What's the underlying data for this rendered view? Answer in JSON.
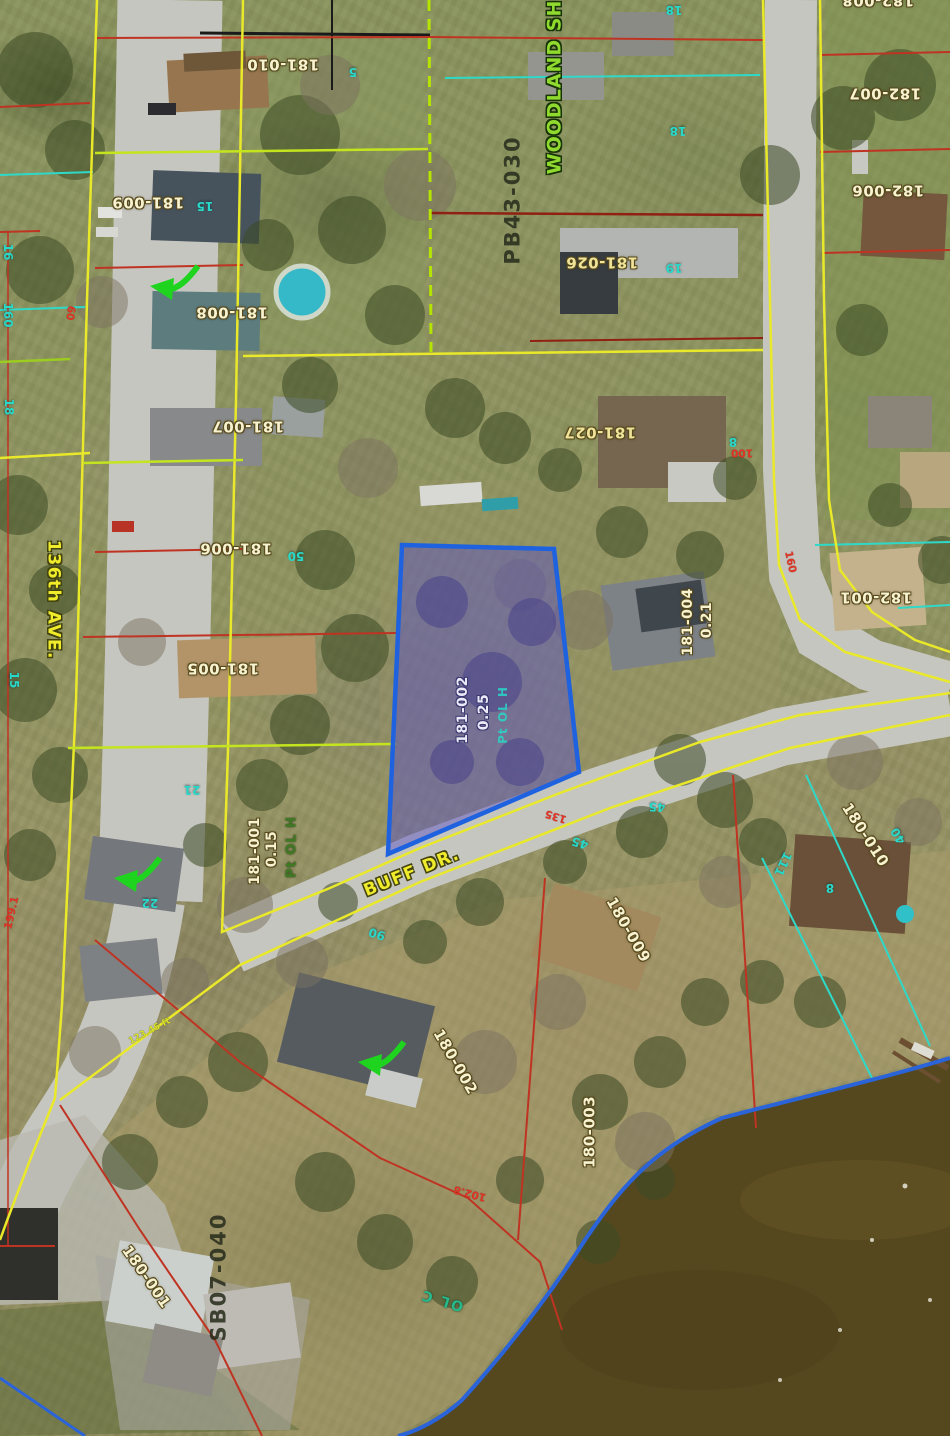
{
  "map": {
    "highlighted_parcel": {
      "id": "181-002",
      "acreage": "0.25"
    },
    "streets": {
      "ave": "136th AVE.",
      "buff": "BUFF DR.",
      "woodland": "WOODLAND SH"
    },
    "plat_labels": {
      "pb": "PB43-030",
      "sb": "SB07-040"
    },
    "outlot_labels": {
      "pt_ol_h_west": "Pt OL H",
      "pt_ol_h_center": "Pt OL H",
      "ol_c": "OL C"
    },
    "parcels": [
      {
        "id": "181-010"
      },
      {
        "id": "181-009"
      },
      {
        "id": "181-008"
      },
      {
        "id": "181-007"
      },
      {
        "id": "181-006"
      },
      {
        "id": "181-005"
      },
      {
        "id": "181-001",
        "acreage": "0.15"
      },
      {
        "id": "181-004",
        "acreage": "0.21"
      },
      {
        "id": "181-026"
      },
      {
        "id": "181-027"
      },
      {
        "id": "182-008"
      },
      {
        "id": "182-007"
      },
      {
        "id": "182-006"
      },
      {
        "id": "182-001"
      },
      {
        "id": "180-010"
      },
      {
        "id": "180-009"
      },
      {
        "id": "180-002"
      },
      {
        "id": "180-003"
      },
      {
        "id": "180-001"
      }
    ],
    "lot_numbers": [
      "5",
      "15",
      "18",
      "18",
      "19",
      "8",
      "50",
      "21",
      "22",
      "90",
      "45",
      "45",
      "111",
      "8",
      "40",
      "16",
      "160",
      "18",
      "15"
    ],
    "road_dimensions": [
      "60",
      "135",
      "160",
      "100",
      "199.1",
      "102.8"
    ],
    "dimension_note": "123.45 ft",
    "colors": {
      "highlight_border": "#1e62e0",
      "highlight_fill": "#5a52c4",
      "parcel_line_yellow": "#e9e92a",
      "parcel_line_red": "#bf3322",
      "parcel_line_teal": "#2fd9c9",
      "section_dashed_green": "#b4e400",
      "shoreline_blue": "#2b64d8",
      "label_cream": "#f7f2cf",
      "label_cyan": "#28d8c8",
      "label_red": "#e03425",
      "street_yellow": "#f0ec2c",
      "street_green": "#90da2f",
      "plat_dark": "#262b1b",
      "arrow_green": "#1fd41f"
    }
  }
}
